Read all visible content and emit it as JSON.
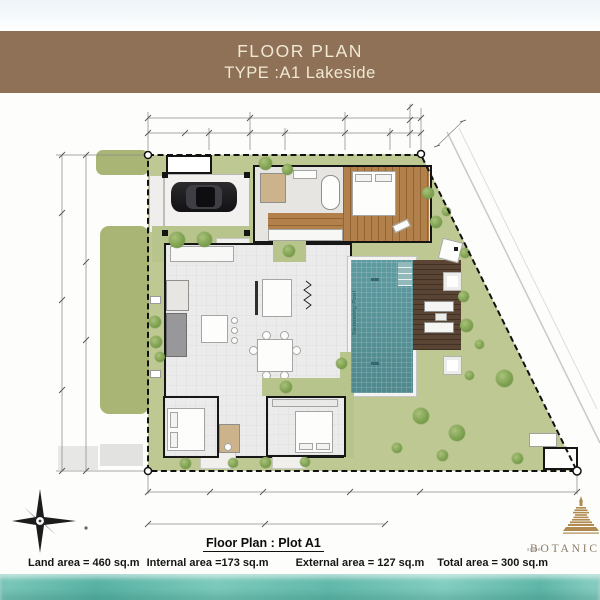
{
  "header": {
    "title": "FLOOR PLAN",
    "subtitle": "TYPE :A1  Lakeside"
  },
  "plan": {
    "pool_label": "Swimming Pool",
    "colors": {
      "banner_brown": "#8e7156",
      "banner_text": "#f1e8d4",
      "lawn": "#bdc893",
      "lawn_outside": "#a8b574",
      "pool_teal": "#579296",
      "deck_brown": "#5a4434",
      "wood_floor": "#b2814b",
      "wall_black": "#161616",
      "watercolor_teal": "#6fc2b4",
      "logo_gold": "#b08a50"
    },
    "trees": [
      [
        265,
        163,
        13
      ],
      [
        287,
        169,
        11
      ],
      [
        177,
        240,
        16
      ],
      [
        204,
        239,
        15
      ],
      [
        155,
        322,
        12
      ],
      [
        156,
        342,
        12
      ],
      [
        160,
        357,
        10
      ],
      [
        289,
        251,
        12
      ],
      [
        286,
        387,
        12
      ],
      [
        341,
        363,
        11
      ],
      [
        428,
        193,
        12
      ],
      [
        436,
        222,
        12
      ],
      [
        446,
        211,
        9
      ],
      [
        465,
        253,
        10
      ],
      [
        463,
        296,
        11
      ],
      [
        466,
        325,
        13
      ],
      [
        479,
        344,
        9
      ],
      [
        469,
        375,
        9
      ],
      [
        504,
        378,
        17
      ],
      [
        421,
        416,
        16
      ],
      [
        457,
        433,
        16
      ],
      [
        442,
        455,
        11
      ],
      [
        397,
        448,
        10
      ],
      [
        185,
        463,
        11
      ],
      [
        233,
        463,
        10
      ],
      [
        265,
        462,
        11
      ],
      [
        305,
        462,
        10
      ],
      [
        517,
        458,
        11
      ]
    ],
    "planters": [
      [
        443,
        272
      ],
      [
        443,
        356
      ]
    ]
  },
  "footer": {
    "plan_title": "Floor Plan : Plot A1",
    "area_line": {
      "land": "Land area = 460 sq.m",
      "internal": "Internal area =173 sq.m",
      "external": "External area = 127 sq.m",
      "total": "Total area = 300 sq.m"
    },
    "scale_label": "scale",
    "brand": "BOTANICA"
  }
}
